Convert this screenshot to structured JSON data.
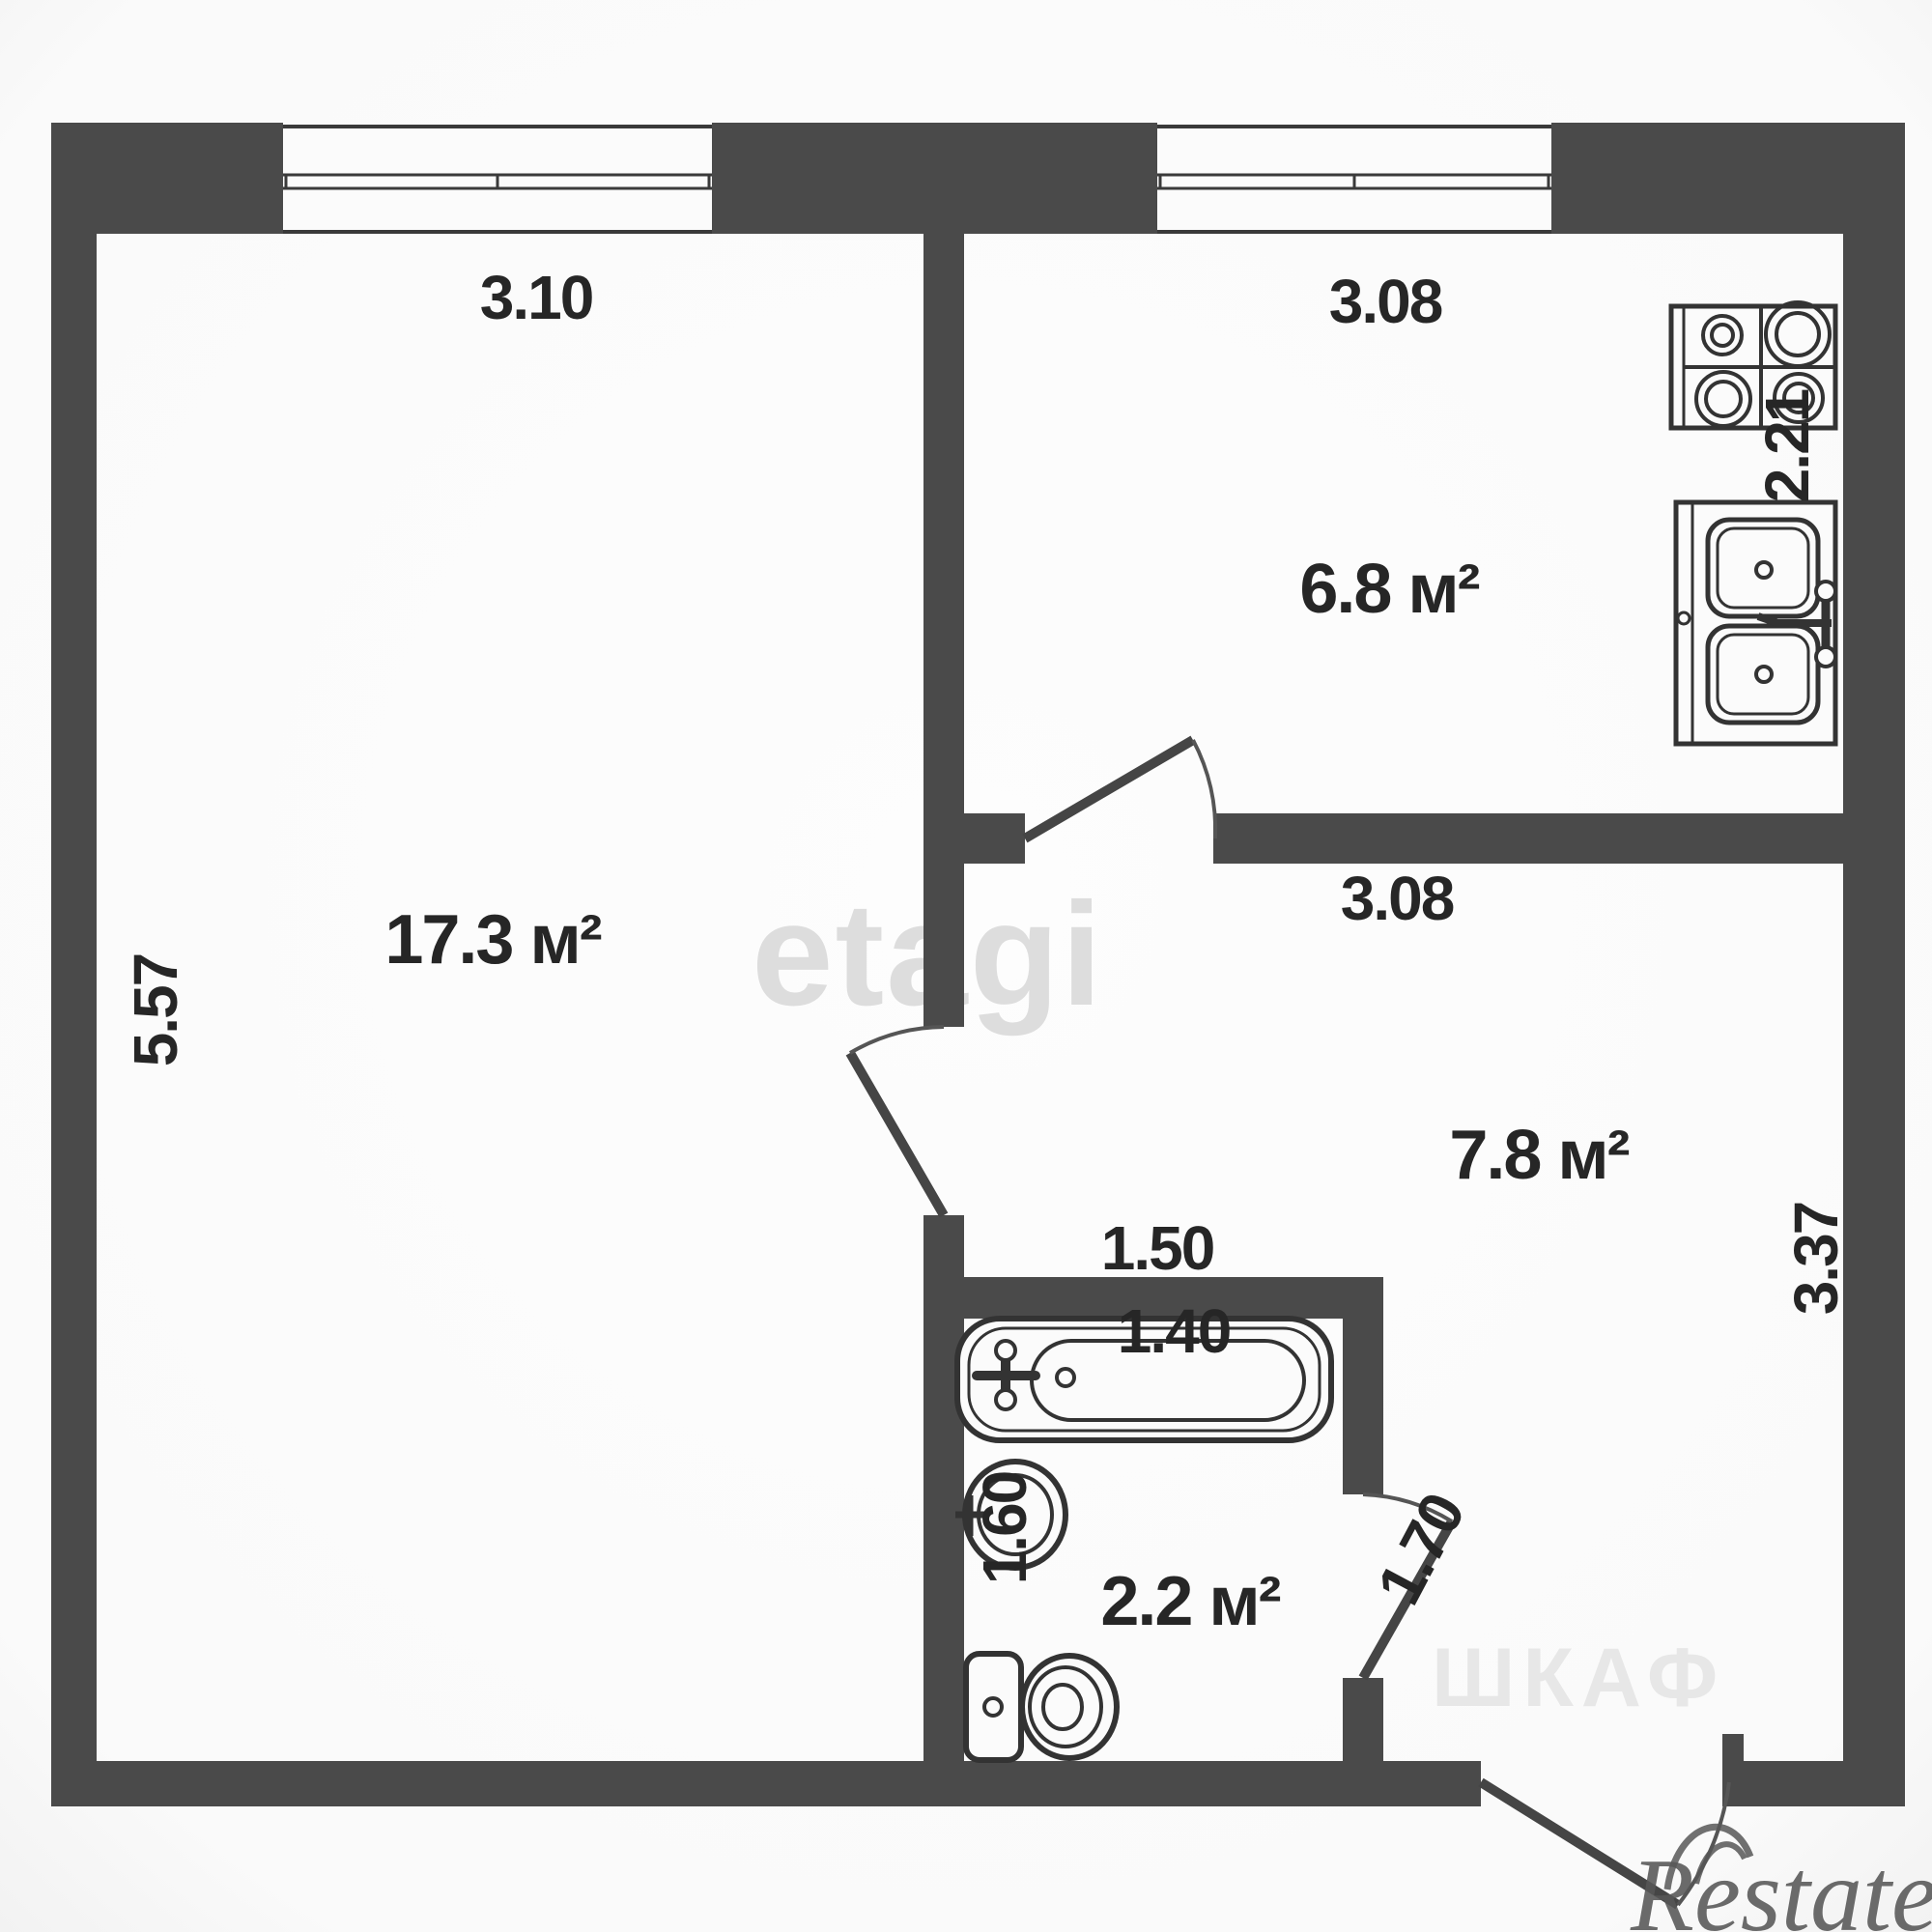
{
  "plan": {
    "living": {
      "area": "17.3 м²",
      "width": "3.10",
      "height": "5.57"
    },
    "kitchen": {
      "area": "6.8 м²",
      "width": "3.08",
      "depth": "2.21"
    },
    "hallway": {
      "area": "7.8 м²",
      "width": "3.08",
      "depth": "3.37"
    },
    "bathroom": {
      "area": "2.2 м²",
      "width": "1.50",
      "depth": "1.60",
      "bath_length": "1.40",
      "door_width": "1.70"
    }
  },
  "watermarks": {
    "center": "etagi",
    "corner": "Restate",
    "closet": "ШКАФ"
  },
  "colors": {
    "wall": "#4a4a4a",
    "fixture_line": "#333333",
    "label": "#262626",
    "background": "#fafafa",
    "watermark_center": "#d6d6d6",
    "watermark_corner": "#575757",
    "watermark_closet": "#e7e7e7"
  }
}
